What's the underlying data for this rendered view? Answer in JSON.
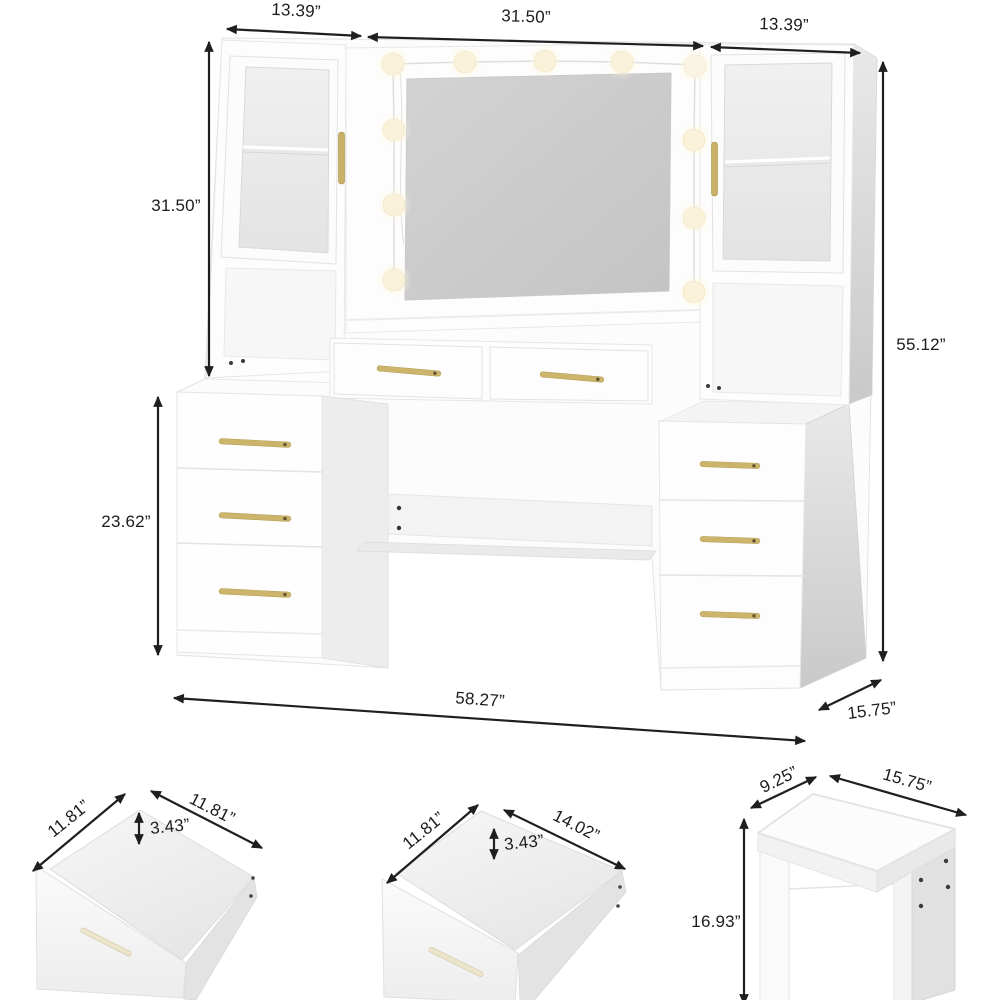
{
  "diagram_title": "Vanity desk with lighted mirror, drawers and stool — dimension diagram",
  "colors": {
    "accent_gold": "#c9b167",
    "arrow_ink": "#1f1f1f",
    "mirror_glass": "#cbcbcb",
    "bulb_warm": "#f9f1da",
    "side_shadow": "#d2d2d2"
  },
  "main_unit": {
    "labels": {
      "top_left_width": "13.39”",
      "top_center_width": "31.50”",
      "top_right_width": "13.39”",
      "hutch_height": "31.50”",
      "overall_height": "55.12”",
      "pedestal_height": "23.62”",
      "overall_width": "58.27”",
      "depth": "15.75”"
    },
    "light_bulb_count": 11
  },
  "small_drawer": {
    "labels": {
      "width": "11.81”",
      "depth": "11.81”",
      "height": "3.43”"
    }
  },
  "large_drawer": {
    "labels": {
      "width": "11.81”",
      "depth": "14.02”",
      "height": "3.43”"
    }
  },
  "stool": {
    "labels": {
      "depth": "9.25”",
      "width": "15.75”",
      "height": "16.93”"
    }
  }
}
